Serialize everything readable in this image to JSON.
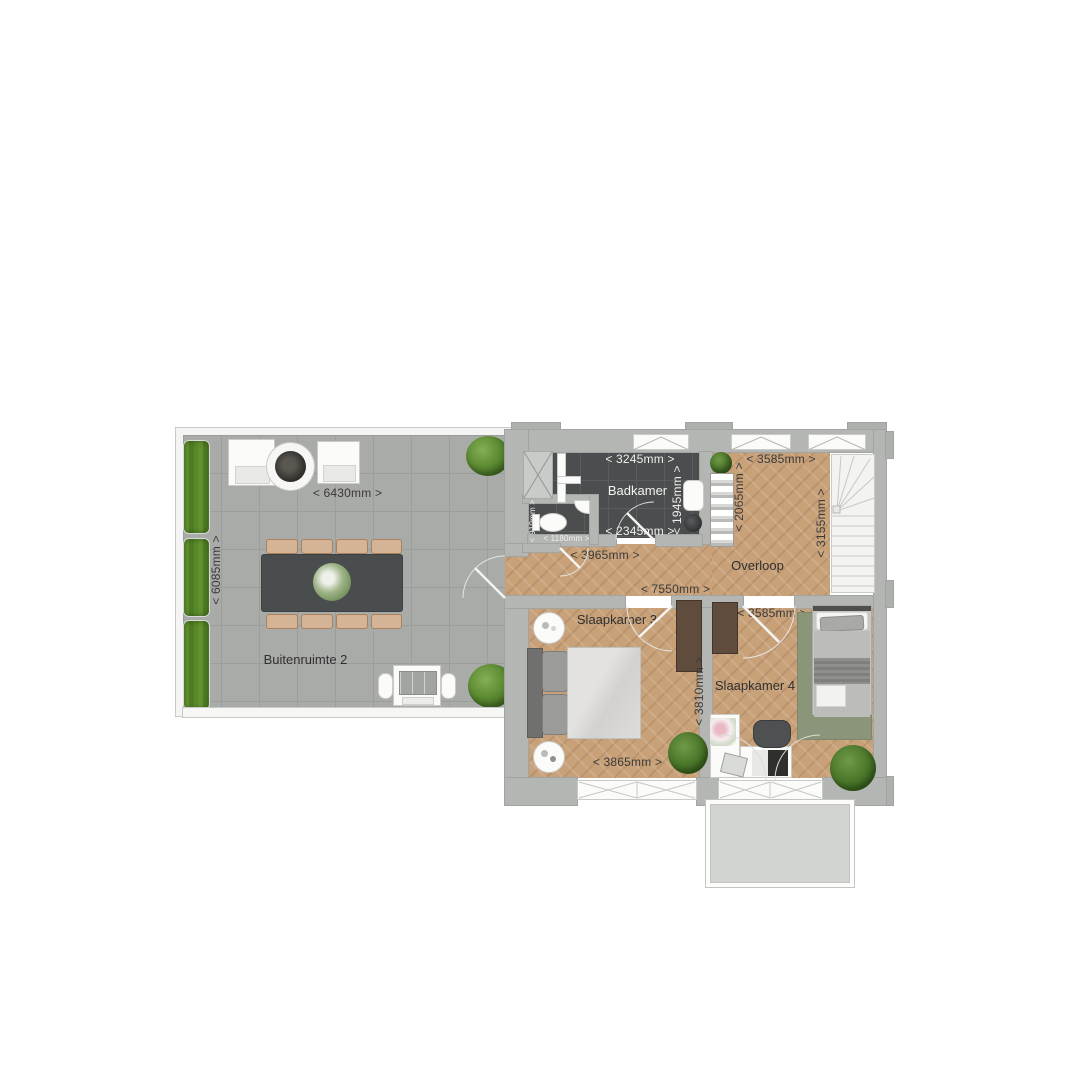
{
  "rooms": {
    "buitenruimte2": {
      "label": "Buitenruimte 2"
    },
    "badkamer": {
      "label": "Badkamer"
    },
    "overloop": {
      "label": "Overloop"
    },
    "slaapkamer3": {
      "label": "Slaapkamer 3"
    },
    "slaapkamer4": {
      "label": "Slaapkamer 4"
    }
  },
  "dimensions": {
    "terrace_width": "< 6430mm >",
    "terrace_depth": "< 6085mm >",
    "badkamer_top": "< 3245mm >",
    "badkamer_right": "< 1945mm >",
    "badkamer_bottom": "< 2345mm >",
    "toilet_depth": "< 910mm >",
    "toilet_width": "< 1180mm >",
    "hall_width": "< 3965mm >",
    "overloop_top": "< 3585mm >",
    "overloop_left": "< 2065mm >",
    "stairs_right": "< 3155mm >",
    "landing_total": "< 7550mm >",
    "slaapkamer3_right": "< 3810mm >",
    "slaapkamer3_bottom": "< 3865mm >",
    "slaapkamer4_top": "< 3585mm >"
  },
  "colors": {
    "wood_floor": "#c8a179",
    "outdoor_tile": "#a9aba8",
    "bathroom_tile": "#4b4d4f",
    "hedge_green": "#5c8a2b",
    "rug_green": "#8b9579",
    "wall_gray": "#b4b6b3"
  }
}
